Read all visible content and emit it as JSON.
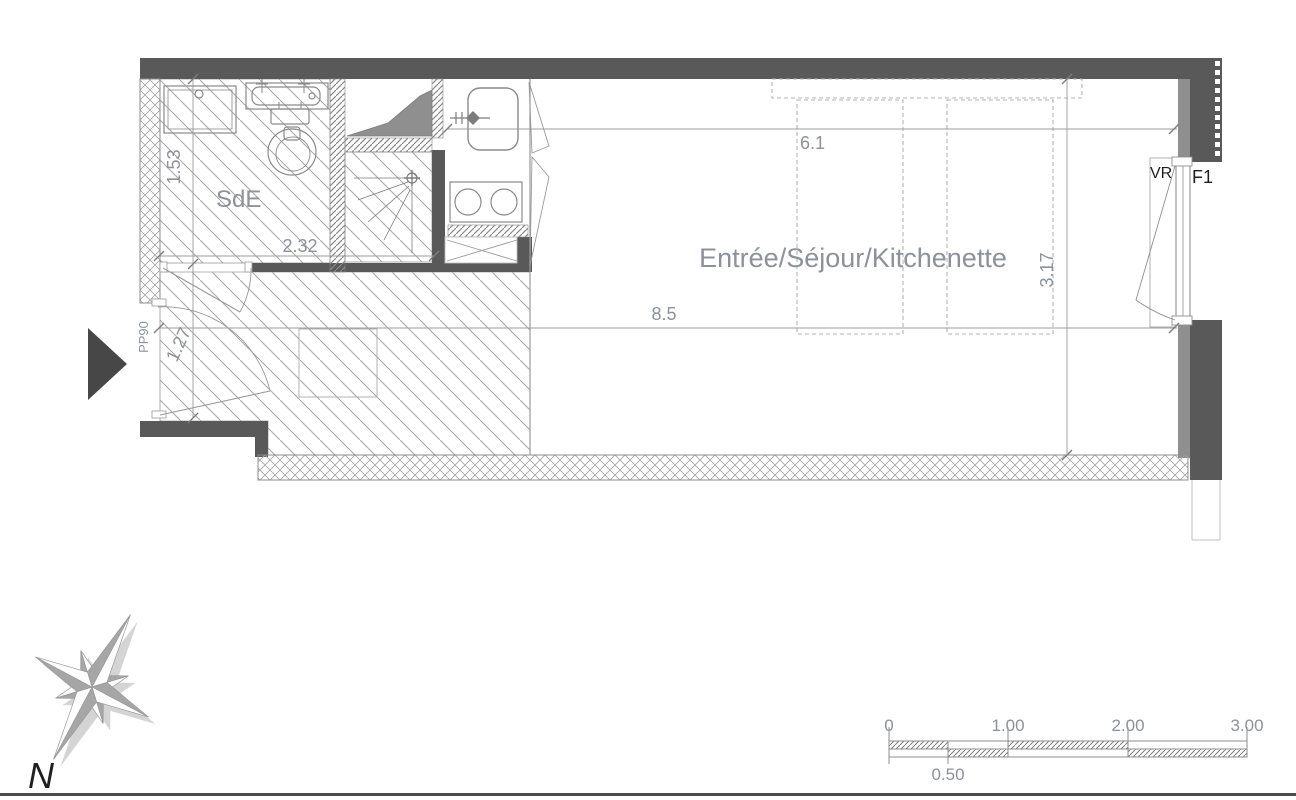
{
  "labels": {
    "bathroom": "SdE",
    "main_room": "Entrée/Séjour/Kitchenette",
    "entrance_door": "PP90",
    "window": "VR",
    "unit": "F1",
    "north": "N"
  },
  "dimensions": {
    "sde_height": "1.53",
    "sde_width": "2.32",
    "entry_height": "1.27",
    "room_width": "8.5",
    "storage_run": "6.1",
    "room_depth": "3.17"
  },
  "scale_bar": {
    "ticks_top": [
      "0",
      "1.00",
      "2.00",
      "3.00"
    ],
    "tick_bottom": "0.50"
  },
  "colors": {
    "wall_dark": "#595959",
    "wall_medium": "#8f8f8f",
    "drawing_line": "#8a8a8a",
    "text_gray": "#8b929b",
    "text_dark": "#1f1f1f"
  }
}
